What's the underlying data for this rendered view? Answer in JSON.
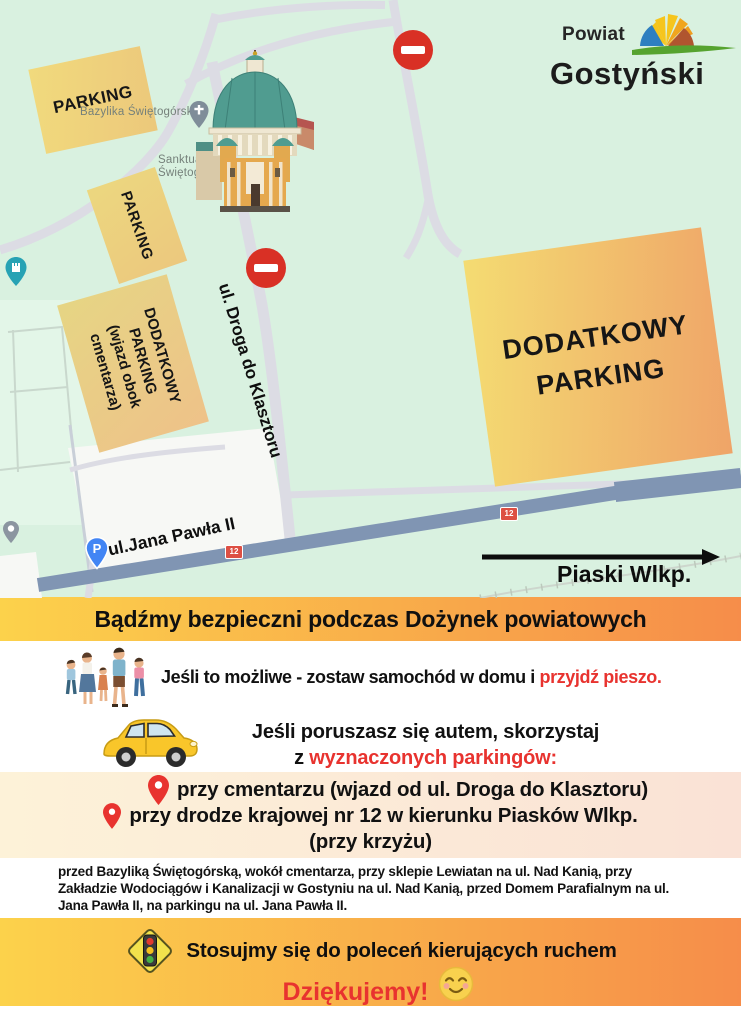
{
  "logo": {
    "line1": "Powiat",
    "line2": "Gostyński"
  },
  "map": {
    "poi": {
      "basilica_label": "Bazylika Świętogórska",
      "sanctuary_label_line1": "Sanktua",
      "sanctuary_label_line2": "Świętog"
    },
    "streets": {
      "klasztor": "ul. Droga do Klasztoru",
      "jana_pawla": "ul.Jana Pawła II"
    },
    "road_number": "12",
    "direction_label": "Piaski Wlkp.",
    "parking_pin_letter": "P",
    "zones": {
      "zone1": "PARKING",
      "zone2": "PARKING",
      "zone3_lines": [
        "DODATKOWY",
        "PARKING",
        "(wjazd obok",
        "cmentarza)"
      ],
      "zone4_lines": [
        "DODATKOWY",
        "PARKING"
      ]
    }
  },
  "banner_top": {
    "text": "Bądźmy bezpieczni podczas Dożynek powiatowych"
  },
  "advice_walk": {
    "text": "Jeśli to możliwe - zostaw samochód w domu i",
    "highlight": "przyjdź pieszo."
  },
  "advice_car": {
    "line1": "Jeśli poruszasz się autem, skorzystaj",
    "line2_prefix": "z",
    "line2_highlight": "wyznaczonych parkingów:"
  },
  "parking_list": {
    "item1": "przy cmentarzu (wjazd od ul. Droga do Klasztoru)",
    "item2_line1": "przy drodze krajowej nr 12 w kierunku Piasków Wlkp.",
    "item2_line2": "(przy krzyżu)"
  },
  "details": "przed Bazyliką Świętogórską, wokół cmentarza,  przy sklepie Lewiatan na ul. Nad Kanią, przy Zakładzie Wodociągów i Kanalizacji w Gostyniu na ul. Nad Kanią, przed Domem Parafialnym na ul. Jana Pawła II, na parkingu na ul. Jana Pawła II.",
  "banner_bottom": {
    "line1": "Stosujmy się do poleceń kierujących ruchem",
    "line2": "Dziękujemy!"
  },
  "icons": {
    "no_entry": "no-entry-sign",
    "church": "church-pin",
    "castle": "castle-pin",
    "monument": "monument-pin",
    "parking_pin": "parking-pin",
    "family": "family-walking-icon",
    "car": "yellow-car-icon",
    "location_pin": "red-location-pin",
    "traffic_light": "traffic-light-sign-icon",
    "smiley": "blushing-smiley-icon",
    "arrow_right": "direction-arrow"
  },
  "colors": {
    "accent_red": "#e8332f",
    "banner_from": "#fcd24b",
    "banner_to": "#f68d4a",
    "map_bg": "#d9f1e0",
    "road12": "#8095b3",
    "sign_red": "#d93025",
    "pin_blue": "#4285f4",
    "pin_teal": "#27a2b4",
    "zone_yellow": "#f4dc72",
    "zone_orange": "#efa468"
  }
}
